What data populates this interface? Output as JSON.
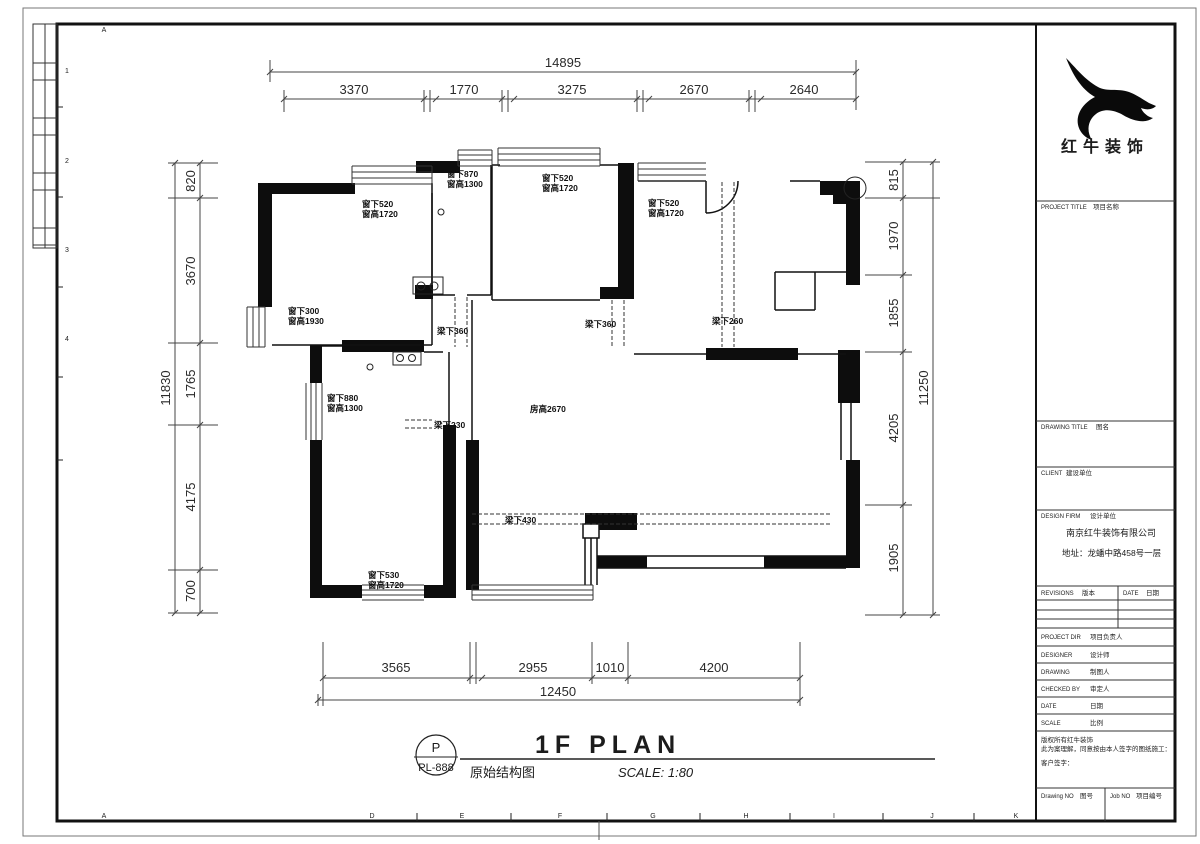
{
  "sheet": {
    "grid_top": [
      "A"
    ],
    "grid_bottom": [
      "A",
      "D",
      "E",
      "F",
      "G",
      "H",
      "I",
      "J",
      "K"
    ],
    "grid_left": [
      "1",
      "2",
      "3",
      "4"
    ]
  },
  "dims": {
    "top_total": "14895",
    "top_segs": [
      "3370",
      "1770",
      "3275",
      "2670",
      "2640"
    ],
    "left_total": "11830",
    "left_segs": [
      "820",
      "3670",
      "1765",
      "4175",
      "700"
    ],
    "right_total": "11250",
    "right_segs": [
      "815",
      "1970",
      "1855",
      "4205",
      "1905"
    ],
    "bottom_total": "12450",
    "bottom_segs": [
      "3565",
      "2955",
      "1010",
      "4200"
    ]
  },
  "plan": {
    "annotations": {
      "tl_top_window": [
        "窗下520",
        "窗高1720"
      ],
      "kitchen_window": [
        "窗下870",
        "窗高1300"
      ],
      "center_window": [
        "窗下520",
        "窗高1720"
      ],
      "right_window": [
        "窗下520",
        "窗高1720"
      ],
      "tl_left_window": [
        "窗下300",
        "窗高1930"
      ],
      "mid_left_window": [
        "窗下880",
        "窗高1300"
      ],
      "bl_window": [
        "窗下530",
        "窗高1720"
      ],
      "beam_hall": "梁下360",
      "beam_center": "梁下360",
      "beam_right": "梁下260",
      "beam_mid": "梁下230",
      "beam_living": "梁下430",
      "room_height": "房高2670"
    }
  },
  "stamp": {
    "letter": "P",
    "code": "PL-888"
  },
  "drawing_title": {
    "main": "1F PLAN",
    "sub": "原始结构图",
    "scale": "SCALE: 1:80"
  },
  "title_block": {
    "company": "红牛装饰",
    "rows": {
      "project_title": {
        "en": "PROJECT TITLE",
        "cn": "项目名称"
      },
      "drawing_title": {
        "en": "DRAWING TITLE",
        "cn": "图名"
      },
      "client": {
        "en": "CLIENT",
        "cn": "建设单位"
      },
      "design_firm": {
        "en": "DESIGN FIRM",
        "cn": "设计单位"
      },
      "revisions": {
        "en": "REVISIONS",
        "cn": "版本"
      },
      "date_col": {
        "en": "DATE",
        "cn": "日期"
      },
      "project_dir": {
        "en": "PROJECT DIR",
        "cn": "项目负责人"
      },
      "designer": {
        "en": "DESIGNER",
        "cn": "设计师"
      },
      "drawing": {
        "en": "DRAWING",
        "cn": "制图人"
      },
      "checked_by": {
        "en": "CHECKED BY",
        "cn": "审定人"
      },
      "date": {
        "en": "DATE",
        "cn": "日期"
      },
      "scale": {
        "en": "SCALE",
        "cn": "比例"
      },
      "drawing_no": {
        "en": "Drawing NO",
        "cn": "图号"
      },
      "job_no": {
        "en": "Job NO",
        "cn": "项目编号"
      }
    },
    "firm_name": "南京红牛装饰有限公司",
    "firm_address": "地址：龙蟠中路458号一层",
    "notes": [
      "版权所有红牛装饰",
      "此为案理解，同意按由本人签字的图纸施工：",
      "客户签字："
    ]
  }
}
